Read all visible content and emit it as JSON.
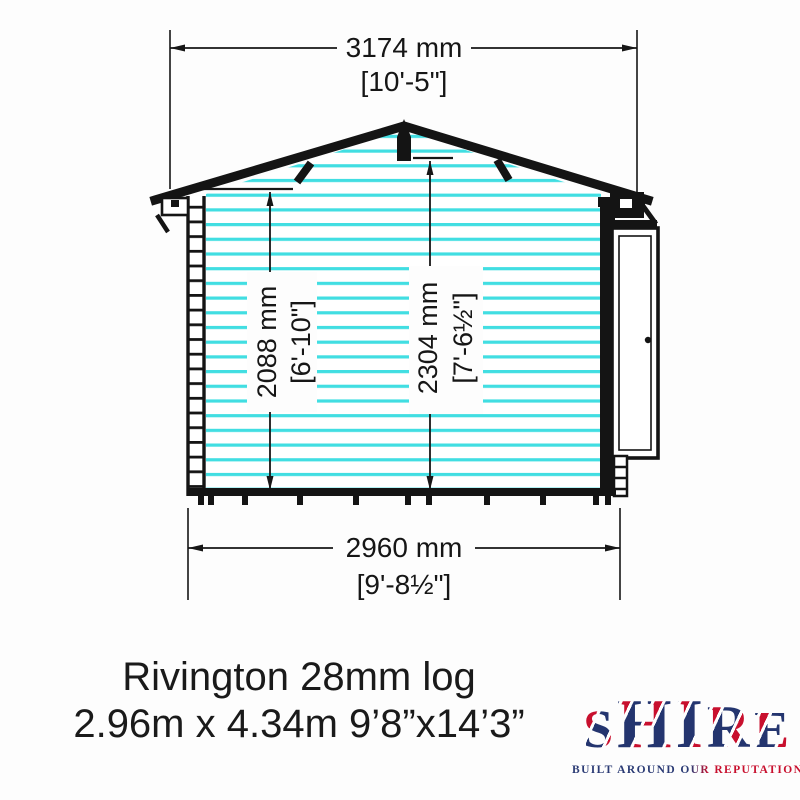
{
  "diagram": {
    "title": "Rivington log cabin side elevation",
    "dimensions": {
      "roof_width": {
        "metric": "3174 mm",
        "imperial": "[10'-5\"]"
      },
      "base_width": {
        "metric": "2960 mm",
        "imperial": "[9'-8½\"]"
      },
      "eaves_height": {
        "metric": "2088 mm",
        "imperial": "[6'-10\"]"
      },
      "ridge_height": {
        "metric": "2304 mm",
        "imperial": "[7'-6½\"]"
      }
    },
    "colors": {
      "log_stripe": "#41dee2",
      "line": "#161616"
    }
  },
  "caption": {
    "line1": "Rivington 28mm log",
    "line2": "2.96m x 4.34m 9’8”x14’3”"
  },
  "logo": {
    "letters": [
      "S",
      "H",
      "I",
      "R",
      "E"
    ],
    "tagline": "BUILT AROUND OUR REPUTATION",
    "colors": {
      "navy": "#24356f",
      "red": "#c8102e",
      "white": "#ffffff"
    }
  }
}
